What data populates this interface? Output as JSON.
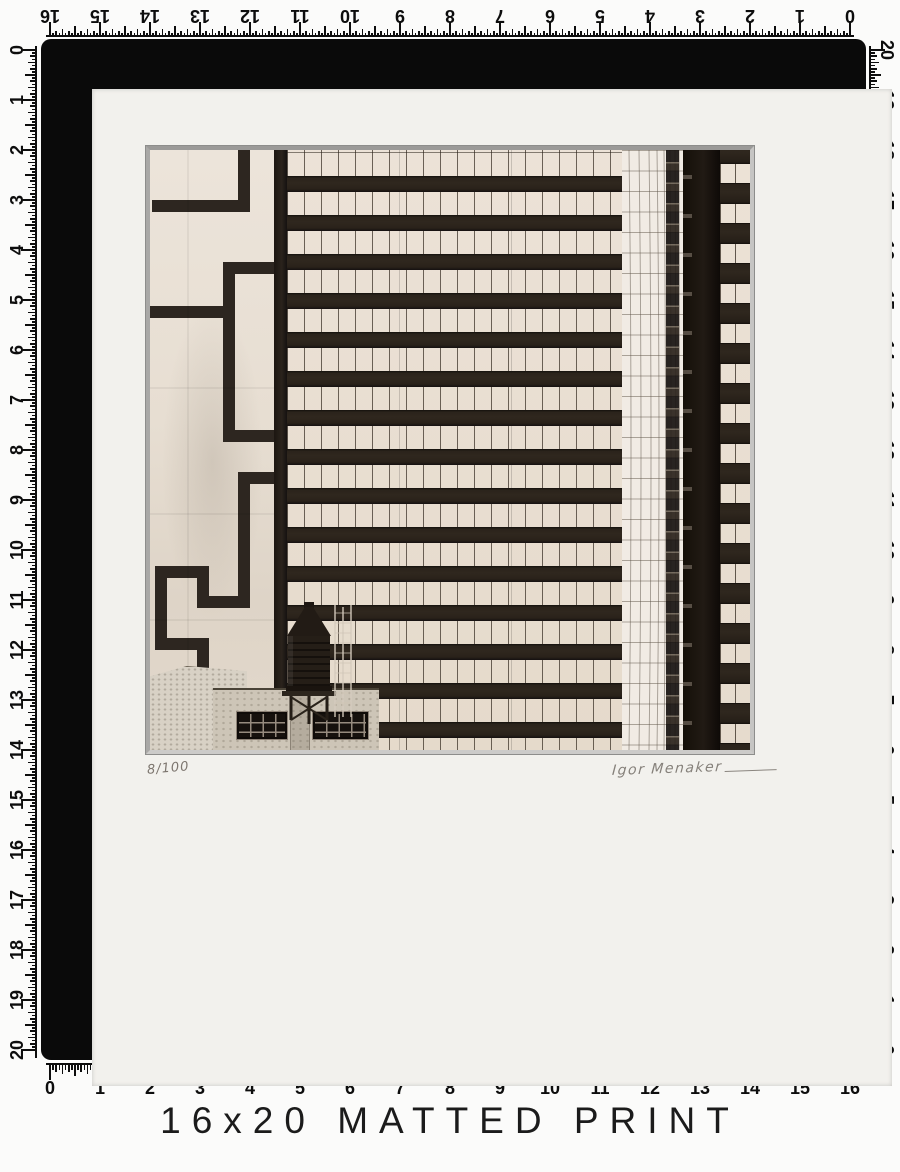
{
  "page": {
    "background": "#fbfbfa",
    "caption": "16x20 MATTED PRINT"
  },
  "product": {
    "frame_color": "#0a0a0a",
    "mat_color": "#f2f1ed",
    "mat_size_label": "16x20"
  },
  "rulers": {
    "unit": "inches",
    "divisions_per_inch": 16,
    "top": {
      "labels": [
        "16",
        "15",
        "14",
        "13",
        "12",
        "11",
        "10",
        "9",
        "8",
        "7",
        "6",
        "5",
        "4",
        "3",
        "2",
        "1",
        "0"
      ]
    },
    "bottom": {
      "labels": [
        "0",
        "1",
        "2",
        "3",
        "4",
        "5",
        "6",
        "7",
        "8",
        "9",
        "10",
        "11",
        "12",
        "13",
        "14",
        "15",
        "16"
      ]
    },
    "left": {
      "labels": [
        "0",
        "1",
        "2",
        "3",
        "4",
        "5",
        "6",
        "7",
        "8",
        "9",
        "10",
        "11",
        "12",
        "13",
        "14",
        "15",
        "16",
        "17",
        "18",
        "19",
        "20"
      ]
    },
    "right": {
      "labels": [
        "20",
        "19",
        "18",
        "17",
        "16",
        "15",
        "14",
        "13",
        "12",
        "11",
        "10",
        "9",
        "8",
        "7",
        "6",
        "5",
        "4",
        "3",
        "2",
        "1",
        "0"
      ]
    }
  },
  "print": {
    "edition": "8/100",
    "signature": "Igor Menaker"
  },
  "artwork": {
    "style": "black and white architectural photograph, rooftop water tower and striped office towers",
    "palette": {
      "cream": "#e9dfd3",
      "dark_band": "#27211a",
      "concrete": "#e7ded2"
    }
  }
}
